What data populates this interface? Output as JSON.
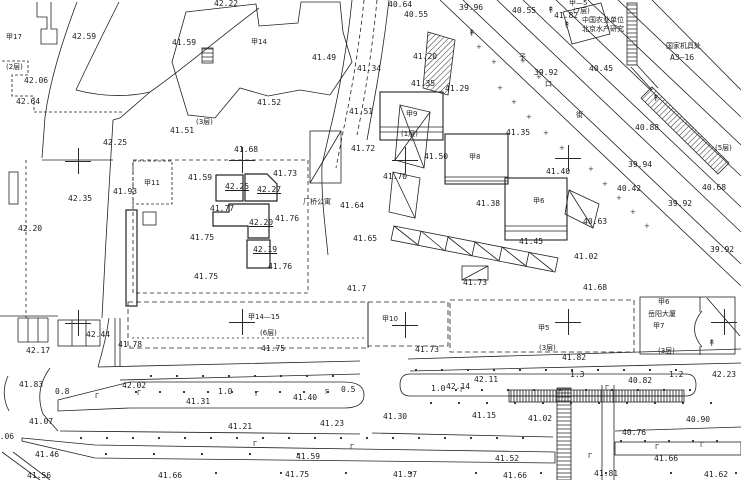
{
  "canvas": {
    "width": 741,
    "height": 480,
    "background": "#ffffff",
    "ink": "#222222"
  },
  "drawing": {
    "kind_note": "black-and-white cadastral / topographic site plan with spot elevations",
    "apartment_label": "厂桥公寓",
    "tower_label": "岳阳大厦",
    "unit_label_line1": "中国农业单位",
    "unit_label_line2": "北京水产研究",
    "depot_label_line1": "国家机具处",
    "depot_label_line2": "A3—16"
  },
  "labels": [
    {
      "t": "42.22",
      "x": 214,
      "y": 0
    },
    {
      "t": "40.64",
      "x": 388,
      "y": 1
    },
    {
      "t": "40.55",
      "x": 404,
      "y": 11
    },
    {
      "t": "39.96",
      "x": 459,
      "y": 4
    },
    {
      "t": "40.55",
      "x": 512,
      "y": 7
    },
    {
      "t": "41.82",
      "x": 554,
      "y": 12
    },
    {
      "t": "甲—5",
      "x": 569,
      "y": 0,
      "c": 1
    },
    {
      "t": "(7层)",
      "x": 573,
      "y": 8,
      "c": 1
    },
    {
      "t": "中国农业单位",
      "x": 582,
      "y": 17,
      "c": 1
    },
    {
      "t": "北京水产研究",
      "x": 582,
      "y": 26,
      "c": 1
    },
    {
      "t": "国家机具处",
      "x": 666,
      "y": 43,
      "c": 1
    },
    {
      "t": "A3—16",
      "x": 670,
      "y": 54
    },
    {
      "t": "42.59",
      "x": 72,
      "y": 33
    },
    {
      "t": "甲17",
      "x": 6,
      "y": 34,
      "c": 1
    },
    {
      "t": "41.59",
      "x": 172,
      "y": 39
    },
    {
      "t": "甲14",
      "x": 251,
      "y": 39,
      "c": 1
    },
    {
      "t": "41.49",
      "x": 312,
      "y": 54
    },
    {
      "t": "41.20",
      "x": 413,
      "y": 53
    },
    {
      "t": "41.34",
      "x": 357,
      "y": 65
    },
    {
      "t": "41.35",
      "x": 411,
      "y": 80
    },
    {
      "t": "41.29",
      "x": 445,
      "y": 85
    },
    {
      "t": "(2层)",
      "x": 6,
      "y": 64,
      "c": 1
    },
    {
      "t": "42.06",
      "x": 24,
      "y": 77
    },
    {
      "t": "42.64",
      "x": 16,
      "y": 98
    },
    {
      "t": "41.52",
      "x": 257,
      "y": 99
    },
    {
      "t": "41.51",
      "x": 349,
      "y": 108
    },
    {
      "t": "39.92",
      "x": 534,
      "y": 69
    },
    {
      "t": "40.45",
      "x": 589,
      "y": 65
    },
    {
      "t": "子",
      "x": 519,
      "y": 54,
      "c": 1
    },
    {
      "t": "口",
      "x": 545,
      "y": 81,
      "c": 1
    },
    {
      "t": "街",
      "x": 576,
      "y": 112,
      "c": 1
    },
    {
      "t": "(3层)",
      "x": 196,
      "y": 119,
      "c": 1
    },
    {
      "t": "41.51",
      "x": 170,
      "y": 127
    },
    {
      "t": "42.25",
      "x": 103,
      "y": 139
    },
    {
      "t": "甲9",
      "x": 406,
      "y": 111,
      "c": 1
    },
    {
      "t": "(1层)",
      "x": 401,
      "y": 131,
      "c": 1
    },
    {
      "t": "41.35",
      "x": 506,
      "y": 129
    },
    {
      "t": "40.88",
      "x": 635,
      "y": 124
    },
    {
      "t": "41.68",
      "x": 234,
      "y": 146
    },
    {
      "t": "41.72",
      "x": 351,
      "y": 145
    },
    {
      "t": "41.50",
      "x": 424,
      "y": 153
    },
    {
      "t": "41.70",
      "x": 383,
      "y": 173
    },
    {
      "t": "41.73",
      "x": 273,
      "y": 170
    },
    {
      "t": "41.59",
      "x": 188,
      "y": 174
    },
    {
      "t": "42.25",
      "x": 225,
      "y": 183,
      "u": 1
    },
    {
      "t": "42.27",
      "x": 257,
      "y": 186,
      "u": 1
    },
    {
      "t": "甲8",
      "x": 469,
      "y": 154,
      "c": 1
    },
    {
      "t": "41.40",
      "x": 546,
      "y": 168
    },
    {
      "t": "39.94",
      "x": 628,
      "y": 161
    },
    {
      "t": "40.42",
      "x": 617,
      "y": 185
    },
    {
      "t": "40.68",
      "x": 702,
      "y": 184
    },
    {
      "t": "(5层)",
      "x": 715,
      "y": 145,
      "c": 1
    },
    {
      "t": "41.93",
      "x": 113,
      "y": 188
    },
    {
      "t": "42.35",
      "x": 68,
      "y": 195
    },
    {
      "t": "41.77",
      "x": 210,
      "y": 205
    },
    {
      "t": "42.20",
      "x": 249,
      "y": 219,
      "u": 1
    },
    {
      "t": "41.76",
      "x": 275,
      "y": 215
    },
    {
      "t": "厂桥公寓",
      "x": 303,
      "y": 199,
      "c": 1
    },
    {
      "t": "41.64",
      "x": 340,
      "y": 202
    },
    {
      "t": "41.38",
      "x": 476,
      "y": 200
    },
    {
      "t": "甲6",
      "x": 533,
      "y": 198,
      "c": 1
    },
    {
      "t": "39.92",
      "x": 668,
      "y": 200
    },
    {
      "t": "40.63",
      "x": 583,
      "y": 218
    },
    {
      "t": "42.20",
      "x": 18,
      "y": 225
    },
    {
      "t": "41.75",
      "x": 190,
      "y": 234
    },
    {
      "t": "42.19",
      "x": 253,
      "y": 246,
      "u": 1
    },
    {
      "t": "41.65",
      "x": 353,
      "y": 235
    },
    {
      "t": "41.45",
      "x": 519,
      "y": 238
    },
    {
      "t": "39.92",
      "x": 710,
      "y": 246
    },
    {
      "t": "41.02",
      "x": 574,
      "y": 253
    },
    {
      "t": "41.76",
      "x": 268,
      "y": 263
    },
    {
      "t": "41.75",
      "x": 194,
      "y": 273
    },
    {
      "t": "41.7",
      "x": 347,
      "y": 285
    },
    {
      "t": "41.73",
      "x": 463,
      "y": 279
    },
    {
      "t": "41.68",
      "x": 583,
      "y": 284
    },
    {
      "t": "甲11",
      "x": 144,
      "y": 180,
      "c": 1
    },
    {
      "t": "甲6",
      "x": 658,
      "y": 299,
      "c": 1
    },
    {
      "t": "岳阳大厦",
      "x": 648,
      "y": 311,
      "c": 1
    },
    {
      "t": "甲7",
      "x": 653,
      "y": 323,
      "c": 1
    },
    {
      "t": "甲14—15",
      "x": 248,
      "y": 314,
      "c": 1
    },
    {
      "t": "(6层)",
      "x": 260,
      "y": 330,
      "c": 1
    },
    {
      "t": "甲10",
      "x": 382,
      "y": 316,
      "c": 1
    },
    {
      "t": "甲5",
      "x": 538,
      "y": 325,
      "c": 1
    },
    {
      "t": "(3层)",
      "x": 539,
      "y": 345,
      "c": 1
    },
    {
      "t": "(3层)",
      "x": 658,
      "y": 348,
      "c": 1
    },
    {
      "t": "42.44",
      "x": 86,
      "y": 331
    },
    {
      "t": "42.17",
      "x": 26,
      "y": 347
    },
    {
      "t": "41.78",
      "x": 118,
      "y": 341
    },
    {
      "t": "41.75",
      "x": 261,
      "y": 345
    },
    {
      "t": "41.73",
      "x": 415,
      "y": 346
    },
    {
      "t": "41.82",
      "x": 562,
      "y": 354
    },
    {
      "t": "1.3",
      "x": 570,
      "y": 371
    },
    {
      "t": "1.2",
      "x": 669,
      "y": 371
    },
    {
      "t": "42.23",
      "x": 712,
      "y": 371
    },
    {
      "t": "41.83",
      "x": 19,
      "y": 381
    },
    {
      "t": "42.02",
      "x": 122,
      "y": 382
    },
    {
      "t": "0.8",
      "x": 55,
      "y": 388
    },
    {
      "t": "1.0",
      "x": 218,
      "y": 388
    },
    {
      "t": "0.5",
      "x": 341,
      "y": 386
    },
    {
      "t": "1.0",
      "x": 431,
      "y": 385
    },
    {
      "t": "42.14",
      "x": 446,
      "y": 383
    },
    {
      "t": "42.11",
      "x": 474,
      "y": 376
    },
    {
      "t": "40.82",
      "x": 628,
      "y": 377
    },
    {
      "t": "41.31",
      "x": 186,
      "y": 398
    },
    {
      "t": "41.40",
      "x": 293,
      "y": 394
    },
    {
      "t": "41.07",
      "x": 29,
      "y": 418
    },
    {
      "t": "41.21",
      "x": 228,
      "y": 423
    },
    {
      "t": "41.23",
      "x": 320,
      "y": 420
    },
    {
      "t": "41.30",
      "x": 383,
      "y": 413
    },
    {
      "t": "41.15",
      "x": 472,
      "y": 412
    },
    {
      "t": "41.02",
      "x": 528,
      "y": 415
    },
    {
      "t": "40.90",
      "x": 686,
      "y": 416
    },
    {
      "t": "40.76",
      "x": 622,
      "y": 429
    },
    {
      "t": "41.06",
      "x": -10,
      "y": 433
    },
    {
      "t": "41.46",
      "x": 35,
      "y": 451
    },
    {
      "t": "41.59",
      "x": 296,
      "y": 453
    },
    {
      "t": "41.52",
      "x": 495,
      "y": 455
    },
    {
      "t": "41.66",
      "x": 654,
      "y": 455
    },
    {
      "t": "41.56",
      "x": 27,
      "y": 472
    },
    {
      "t": "41.66",
      "x": 158,
      "y": 472
    },
    {
      "t": "41.75",
      "x": 285,
      "y": 471
    },
    {
      "t": "41.57",
      "x": 393,
      "y": 471
    },
    {
      "t": "41.66",
      "x": 503,
      "y": 472
    },
    {
      "t": "41.81",
      "x": 594,
      "y": 470
    },
    {
      "t": "41.62",
      "x": 704,
      "y": 471
    }
  ],
  "crosses": [
    [
      78,
      161
    ],
    [
      242,
      160
    ],
    [
      405,
      160
    ],
    [
      568,
      158
    ],
    [
      78,
      323
    ],
    [
      242,
      322
    ],
    [
      405,
      325
    ],
    [
      568,
      322
    ],
    [
      724,
      322
    ]
  ],
  "trees": [
    [
      547,
      7
    ],
    [
      563,
      22
    ],
    [
      468,
      30
    ],
    [
      652,
      95
    ],
    [
      708,
      340
    ]
  ],
  "lamps": [
    [
      137,
      390
    ],
    [
      255,
      391
    ],
    [
      325,
      389
    ],
    [
      460,
      387
    ],
    [
      605,
      385
    ],
    [
      95,
      393
    ],
    [
      253,
      441
    ],
    [
      350,
      444
    ],
    [
      588,
      453
    ],
    [
      655,
      444
    ],
    [
      700,
      442
    ]
  ],
  "dot_rows": [
    {
      "y": 375,
      "x0": 150,
      "x1": 355,
      "step": 26
    },
    {
      "y": 369,
      "x0": 415,
      "x1": 700,
      "step": 26
    },
    {
      "y": 391,
      "x0": 135,
      "x1": 340,
      "step": 24
    },
    {
      "y": 389,
      "x0": 455,
      "x1": 690,
      "step": 26
    },
    {
      "y": 402,
      "x0": 430,
      "x1": 720,
      "step": 28
    },
    {
      "y": 437,
      "x0": 80,
      "x1": 545,
      "step": 26
    },
    {
      "y": 440,
      "x0": 620,
      "x1": 735,
      "step": 24
    },
    {
      "y": 453,
      "x0": 105,
      "x1": 300,
      "step": 48
    },
    {
      "y": 472,
      "x0": 215,
      "x1": 735,
      "step": 65
    }
  ],
  "diag_dots": [
    [
      497,
      85
    ],
    [
      511,
      99
    ],
    [
      526,
      114
    ],
    [
      543,
      130
    ],
    [
      559,
      145
    ],
    [
      476,
      44
    ],
    [
      491,
      59
    ],
    [
      588,
      166
    ],
    [
      602,
      181
    ],
    [
      616,
      195
    ],
    [
      630,
      209
    ],
    [
      644,
      223
    ],
    [
      520,
      58
    ],
    [
      536,
      74
    ]
  ]
}
